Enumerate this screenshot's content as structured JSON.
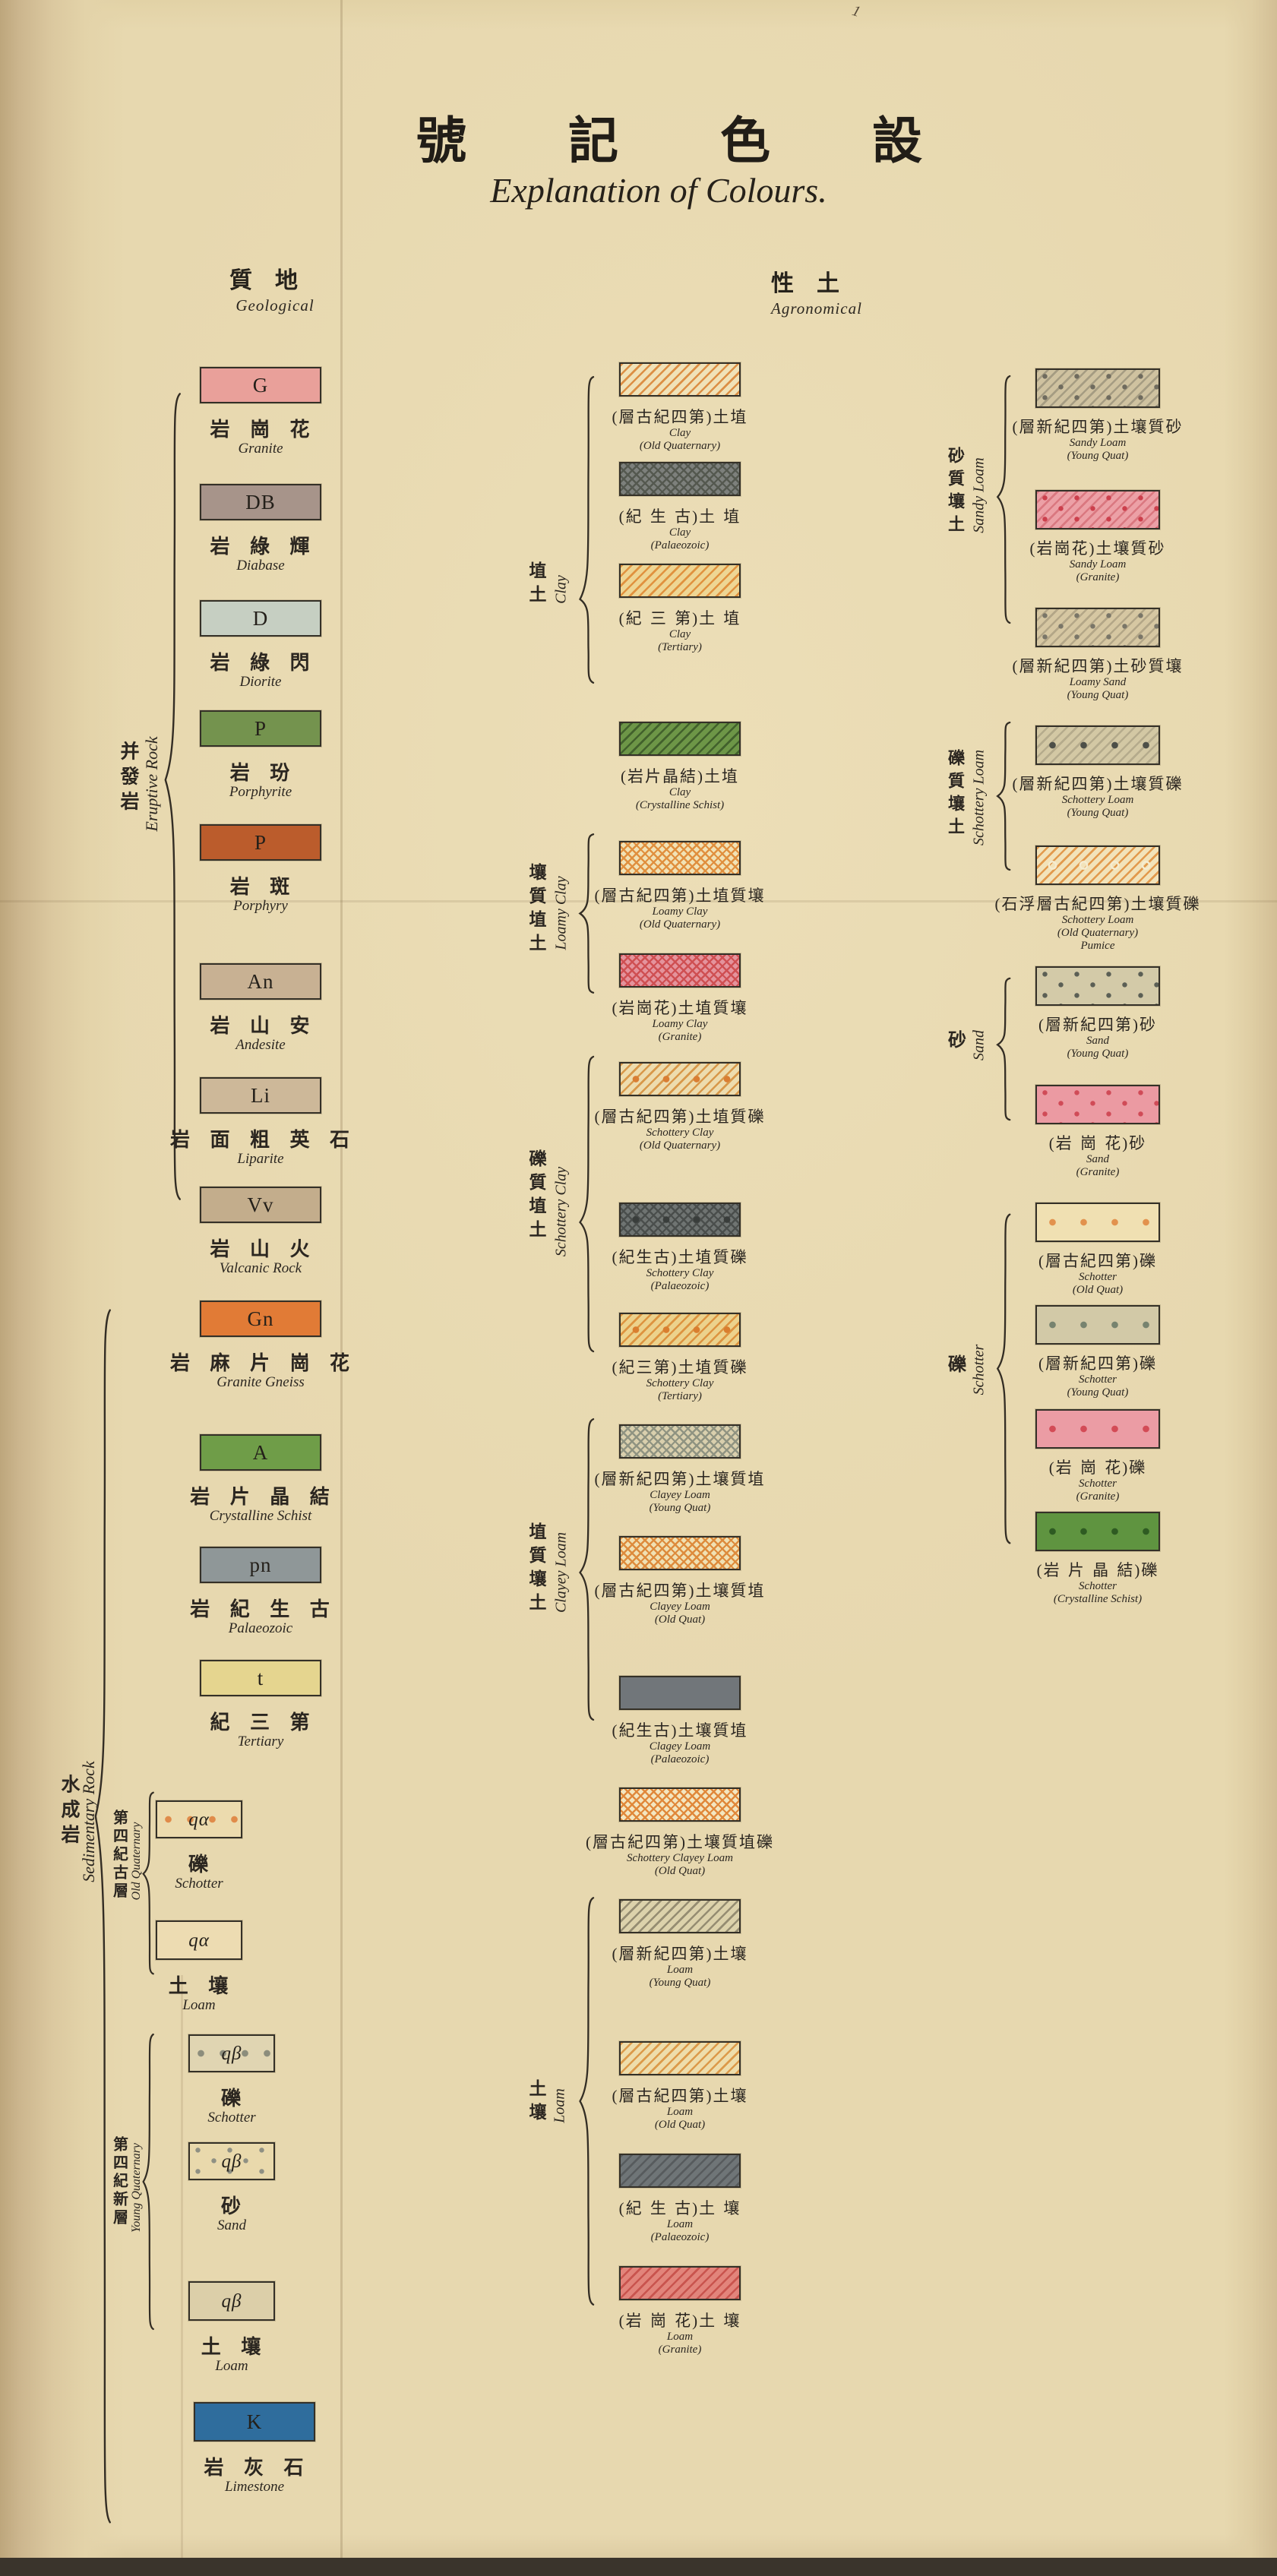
{
  "page": {
    "title_cjk": "號記色設",
    "title_en": "Explanation of Colours.",
    "corner_mark": "1"
  },
  "headers": {
    "geological": {
      "cjk": "質地",
      "en": "Geological"
    },
    "agronomical": {
      "cjk": "性土",
      "en": "Agronomical"
    }
  },
  "groups": {
    "eruptive": {
      "cjk": "并發岩",
      "en": "Eruptive Rock"
    },
    "sedimentary": {
      "cjk": "水成岩",
      "en": "Sedimentary Rock"
    },
    "old_quat": {
      "cjk": "第四紀古層",
      "en": "Old Quaternary"
    },
    "young_quat": {
      "cjk": "第四紀新層",
      "en": "Young Quaternary"
    },
    "clay": {
      "cjk": "埴土",
      "en": "Clay"
    },
    "loamy_clay": {
      "cjk": "壤質埴土",
      "en": "Loamy Clay"
    },
    "schottery_clay": {
      "cjk": "礫質埴土",
      "en": "Schottery Clay"
    },
    "clayey_loam": {
      "cjk": "埴質壤土",
      "en": "Clayey Loam"
    },
    "loam": {
      "cjk": "土壤",
      "en": "Loam"
    },
    "sandy_loam": {
      "cjk": "砂質壤土",
      "en": "Sandy Loam"
    },
    "schottery_loam": {
      "cjk": "礫質壤土",
      "en": "Schottery Loam"
    },
    "sand": {
      "cjk": "砂",
      "en": "Sand"
    },
    "schotter": {
      "cjk": "礫",
      "en": "Schotter"
    }
  },
  "legend": {
    "geological": [
      {
        "code": "G",
        "cjk": "岩 崗 花",
        "en": [
          "Granite"
        ],
        "bg": "#e9a09a",
        "pat": "solid"
      },
      {
        "code": "DB",
        "cjk": "岩 綠 輝",
        "en": [
          "Diabase"
        ],
        "bg": "#a7948a",
        "pat": "solid"
      },
      {
        "code": "D",
        "cjk": "岩 綠 閃",
        "en": [
          "Diorite"
        ],
        "bg": "#c6cfc2",
        "pat": "solid"
      },
      {
        "code": "P",
        "cjk": "岩 玢",
        "en": [
          "Porphyrite"
        ],
        "bg": "#74934e",
        "pat": "solid"
      },
      {
        "code": "P",
        "cjk": "岩 斑",
        "en": [
          "Porphyry"
        ],
        "bg": "#bb5c2c",
        "pat": "solid"
      },
      {
        "code": "An",
        "cjk": "岩 山 安",
        "en": [
          "Andesite"
        ],
        "bg": "#c8b193",
        "pat": "solid"
      },
      {
        "code": "Li",
        "cjk": "岩 面 粗 英 石",
        "en": [
          "Liparite"
        ],
        "bg": "#cdb899",
        "pat": "solid"
      },
      {
        "code": "Vv",
        "cjk": "岩 山 火",
        "en": [
          "Valcanic Rock"
        ],
        "bg": "#c3ad8c",
        "pat": "solid"
      },
      {
        "code": "Gn",
        "cjk": "岩 麻 片 崗 花",
        "en": [
          "Granite Gneiss"
        ],
        "bg": "#e17b36",
        "pat": "solid"
      },
      {
        "code": "A",
        "cjk": "岩 片 晶 結",
        "en": [
          "Crystalline Schist"
        ],
        "bg": "#6f9d48",
        "pat": "solid"
      },
      {
        "code": "pn",
        "cjk": "岩 紀 生 古",
        "en": [
          "Palaeozoic"
        ],
        "bg": "#8f9798",
        "pat": "solid"
      },
      {
        "code": "t",
        "cjk": "紀 三 第",
        "en": [
          "Tertiary"
        ],
        "bg": "#e5d58f",
        "pat": "solid"
      },
      {
        "code": "qα",
        "cjk": "礫",
        "en": [
          "Schotter"
        ],
        "bg": "#ecdbae",
        "pat": "dotrow",
        "c3": "#e08b4a"
      },
      {
        "code": "qα",
        "cjk": "土 壤",
        "en": [
          "Loam"
        ],
        "bg": "#eddcb2",
        "pat": "solid"
      },
      {
        "code": "qβ",
        "cjk": "礫",
        "en": [
          "Schotter"
        ],
        "bg": "#e0d5b2",
        "pat": "dotrow",
        "c3": "#8c8d7c"
      },
      {
        "code": "qβ",
        "cjk": "砂",
        "en": [
          "Sand"
        ],
        "bg": "#e9d9ac",
        "pat": "dots",
        "c3": "#8f9083"
      },
      {
        "code": "qβ",
        "cjk": "土 壤",
        "en": [
          "Loam"
        ],
        "bg": "#dccfa9",
        "pat": "solid"
      },
      {
        "code": "K",
        "cjk": "岩 灰 石",
        "en": [
          "Limestone"
        ],
        "bg": "#2f6d9d",
        "pat": "solid"
      }
    ],
    "agronomical_middle": [
      {
        "cjk": "(層古紀四第)土埴",
        "en": [
          "Clay",
          "(Old  Quaternary)"
        ],
        "bg": "#f0e2b8",
        "pat": "hatch",
        "c2": "#dc8f45"
      },
      {
        "cjk": "(紀 生 古)土 埴",
        "en": [
          "Clay",
          "(Palaeozoic)"
        ],
        "bg": "#7d807c",
        "pat": "cross",
        "c2": "#54584f"
      },
      {
        "cjk": "(紀 三 第)土 埴",
        "en": [
          "Clay",
          "(Tertiary)"
        ],
        "bg": "#eed694",
        "pat": "hatch",
        "c2": "#e0923f"
      },
      {
        "cjk": "(岩片晶結)土埴",
        "en": [
          "Clay",
          "(Crystalline Schist)"
        ],
        "bg": "#6d9647",
        "pat": "hatch",
        "c2": "#42612c"
      },
      {
        "cjk": "(層古紀四第)土埴質壤",
        "en": [
          "Loamy Clay",
          "(Old  Quaternary)"
        ],
        "bg": "#f1e2b5",
        "pat": "cross",
        "c2": "#e08f3e"
      },
      {
        "cjk": "(岩崗花)土埴質壤",
        "en": [
          "Loamy Clay",
          "(Granite)"
        ],
        "bg": "#e4939c",
        "pat": "cross",
        "c2": "#cf4f52"
      },
      {
        "cjk": "(層古紀四第)土埴質礫",
        "en": [
          "Schottery Clay",
          "(Old  Quaternary)"
        ],
        "bg": "#eddcae",
        "pat": "hatch dotrow",
        "c2": "#d8984a",
        "c3": "#d97e33"
      },
      {
        "cjk": "(紀生古)土埴質礫",
        "en": [
          "Schottery Clay",
          "(Palaeozoic)"
        ],
        "bg": "#6f7472",
        "pat": "cross dotrow",
        "c2": "#4a4e4c",
        "c3": "#393d3b"
      },
      {
        "cjk": "(紀三第)土埴質礫",
        "en": [
          "Schottery Clay",
          "(Tertiary)"
        ],
        "bg": "#ecd28c",
        "pat": "hatch dotrow",
        "c2": "#dd9440",
        "c3": "#d97e2f"
      },
      {
        "cjk": "(層新紀四第)土壤質埴",
        "en": [
          "Clayey Loam",
          "(Young Quat)"
        ],
        "bg": "#d9cfad",
        "pat": "cross",
        "c2": "#8f9381"
      },
      {
        "cjk": "(層古紀四第)土壤質埴",
        "en": [
          "Clayey Loam",
          "(Old Quat)"
        ],
        "bg": "#f0e0b2",
        "pat": "cross",
        "c2": "#dd8b3c"
      },
      {
        "cjk": "(紀生古)土壤質埴",
        "en": [
          "Clagey Loam",
          "(Palaeozoic)"
        ],
        "bg": "#71767a",
        "pat": "solid"
      },
      {
        "cjk": "(層古紀四第)土壤質埴礫",
        "en": [
          "Schottery Clayey Loam",
          "(Old Quat)"
        ],
        "bg": "#f3e6c0",
        "pat": "cross",
        "c2": "#e0883a"
      },
      {
        "cjk": "(層新紀四第)土壤",
        "en": [
          "Loam",
          "(Young Quat)"
        ],
        "bg": "#dcd2ab",
        "pat": "hatch",
        "c2": "#958d72"
      },
      {
        "cjk": "(層古紀四第)土壤",
        "en": [
          "Loam",
          "(Old Quat)"
        ],
        "bg": "#eeddab",
        "pat": "hatch",
        "c2": "#dc9a4a"
      },
      {
        "cjk": "(紀 生 古)土 壤",
        "en": [
          "Loam",
          "(Palaeozoic)"
        ],
        "bg": "#6f7577",
        "pat": "hatch",
        "c2": "#575b5d"
      },
      {
        "cjk": "(岩 崗 花)土 壤",
        "en": [
          "Loam",
          "(Granite)"
        ],
        "bg": "#e2847b",
        "pat": "hatch",
        "c2": "#c9544e"
      }
    ],
    "agronomical_right": [
      {
        "cjk": "(層新紀四第)土壤質砂",
        "en": [
          "Sandy Loam",
          "(Young Quat)"
        ],
        "bg": "#cfc2a0",
        "pat": "hatch dots",
        "c2": "#a59c82",
        "c3": "#6f6b5e"
      },
      {
        "cjk": "(岩崗花)土壤質砂",
        "en": [
          "Sandy Loam",
          "(Granite)"
        ],
        "bg": "#eca0a6",
        "pat": "hatch dots",
        "c2": "#da7880",
        "c3": "#cc3f4c"
      },
      {
        "cjk": "(層新紀四第)土砂質壤",
        "en": [
          "Loamy Sand",
          "(Young Quat)"
        ],
        "bg": "#d6c7a2",
        "pat": "hatch dots",
        "c2": "#b3a687",
        "c3": "#7a7668"
      },
      {
        "cjk": "(層新紀四第)土壤質礫",
        "en": [
          "Schottery Loam",
          "(Young Quat)"
        ],
        "bg": "#d3c8a4",
        "pat": "hatch dotrow",
        "c2": "#b5ab8c",
        "c3": "#4d4f48"
      },
      {
        "cjk": "(石浮層古紀四第)土壤質礫",
        "en": [
          "Schottery Loam",
          "(Old  Quaternary)",
          "Pumice"
        ],
        "bg": "#f2e3ba",
        "pat": "hatch ring",
        "c2": "#e29a4d",
        "c3": "#f5ecd0"
      },
      {
        "cjk": "(層新紀四第)砂",
        "en": [
          "Sand",
          "(Young Quat)"
        ],
        "bg": "#d3caa8",
        "pat": "dots",
        "c3": "#5b5f55"
      },
      {
        "cjk": "(岩 崗 花)砂",
        "en": [
          "Sand",
          "(Granite)"
        ],
        "bg": "#eb9aa2",
        "pat": "dots",
        "c3": "#d04b57"
      },
      {
        "cjk": "(層古紀四第)礫",
        "en": [
          "Schotter",
          "(Old Quat)"
        ],
        "bg": "#f0e0b2",
        "pat": "dotrow",
        "c3": "#e2924e"
      },
      {
        "cjk": "(層新紀四第)礫",
        "en": [
          "Schotter",
          "(Young Quat)"
        ],
        "bg": "#d2c9a7",
        "pat": "dotrow",
        "c3": "#77836f"
      },
      {
        "cjk": "(岩 崗 花)礫",
        "en": [
          "Schotter",
          "(Granite)"
        ],
        "bg": "#eb9ca4",
        "pat": "dotrow",
        "c3": "#d34b56"
      },
      {
        "cjk": "(岩 片 晶 結)礫",
        "en": [
          "Schotter",
          "(Crystalline Schist)"
        ],
        "bg": "#5f9440",
        "pat": "dotrow",
        "c3": "#2e5b22"
      }
    ]
  }
}
